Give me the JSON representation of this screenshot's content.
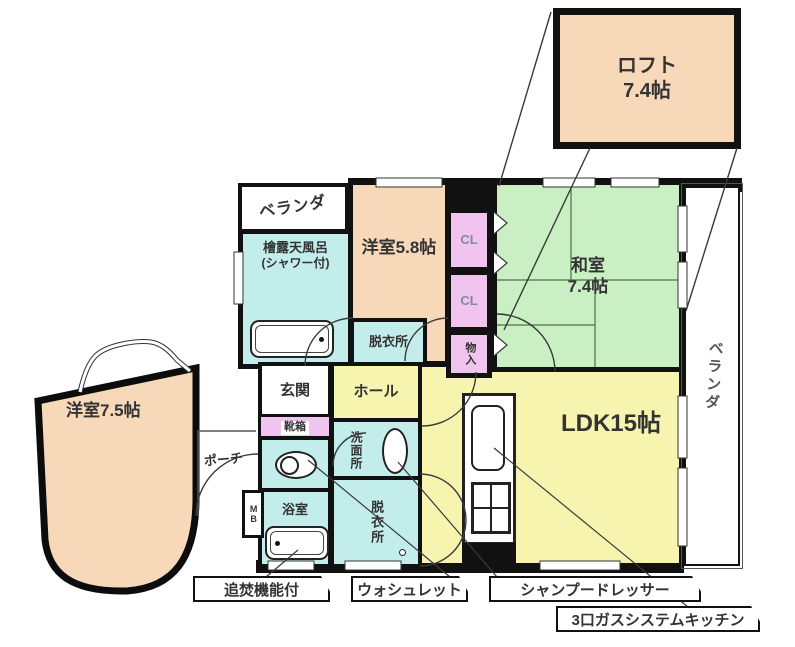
{
  "title": "間取り図",
  "palette": {
    "peach": "#F7D8B8",
    "cyan": "#C3EDEB",
    "green": "#C9EFC2",
    "yellow": "#F6F4AE",
    "pink": "#F1C3EF",
    "wall": "#111111",
    "line": "#3a3a3a"
  },
  "rooms": {
    "loft": {
      "name": "ロフト",
      "size": "7.4帖"
    },
    "veranda_top": {
      "label": "ベランダ"
    },
    "bath_hinoki": {
      "line1": "檜露天風呂",
      "line2": "(シャワー付)"
    },
    "western_58": {
      "label": "洋室5.8帖"
    },
    "dressing_upper": {
      "label": "脱衣所"
    },
    "closet1": {
      "label": "CL"
    },
    "closet2": {
      "label": "CL"
    },
    "storage": {
      "label": "物入"
    },
    "japanese_room": {
      "name": "和室",
      "size": "7.4帖"
    },
    "veranda_right": {
      "label": "ベランダ"
    },
    "ldk": {
      "label": "LDK15帖"
    },
    "hall": {
      "label": "ホール"
    },
    "entrance": {
      "label": "玄関"
    },
    "shoe_box": {
      "label": "靴箱"
    },
    "washroom": {
      "label": "洗面所"
    },
    "bathroom": {
      "label": "浴室"
    },
    "dressing_lower": {
      "label": "脱衣所"
    },
    "western_75": {
      "label": "洋室7.5帖"
    },
    "porch": {
      "label": "ポーチ"
    },
    "meter_box": {
      "label": "MB"
    }
  },
  "callouts": {
    "reheat": "追焚機能付",
    "washlet": "ウォシュレット",
    "shampoo_dresser": "シャンプードレッサー",
    "gas_kitchen": "3口ガスシステムキッチン"
  }
}
